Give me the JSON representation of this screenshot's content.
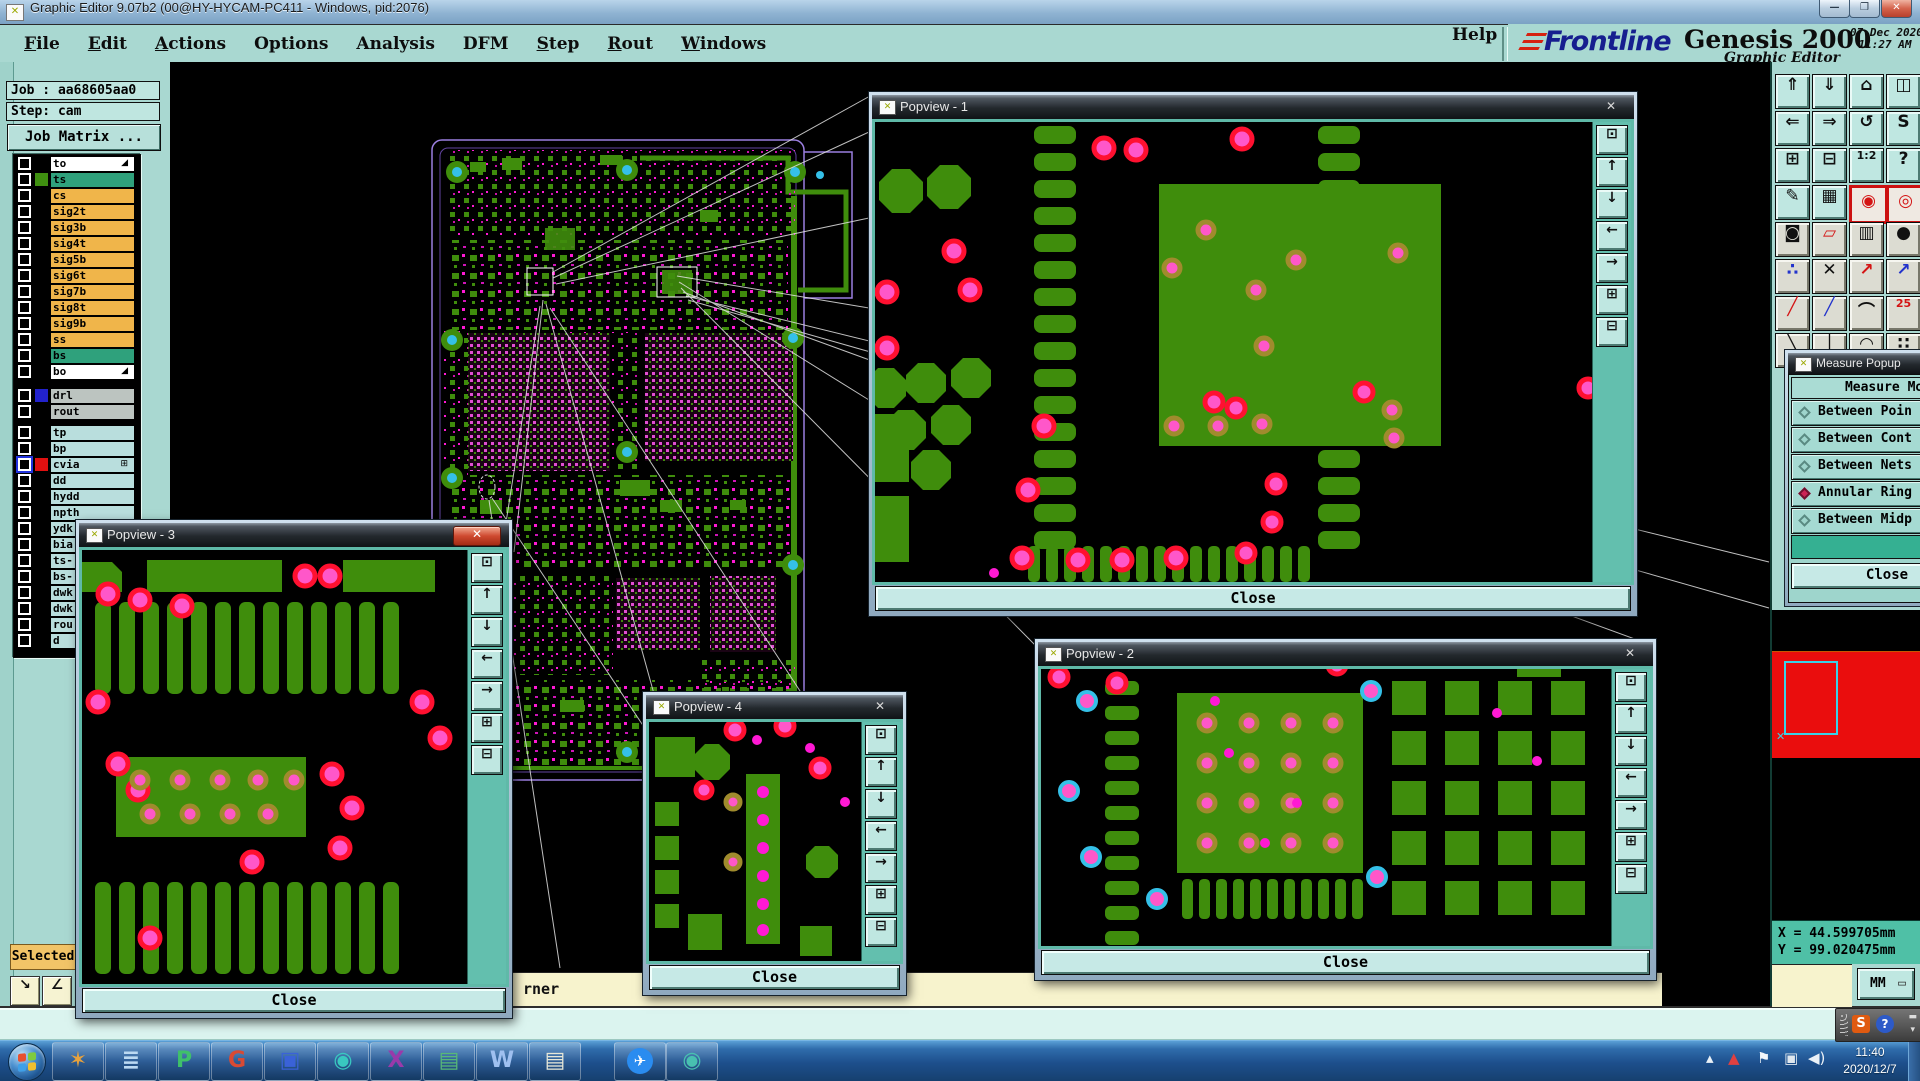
{
  "window": {
    "title": "Graphic Editor 9.07b2 (00@HY-HYCAM-PC411 - Windows, pid:2076)"
  },
  "menubar": {
    "items": [
      {
        "label": "File",
        "u": true
      },
      {
        "label": "Edit",
        "u": true
      },
      {
        "label": "Actions",
        "u": true
      },
      {
        "label": "Options",
        "u": false
      },
      {
        "label": "Analysis",
        "u": false
      },
      {
        "label": "DFM",
        "u": false
      },
      {
        "label": "Step",
        "u": true
      },
      {
        "label": "Rout",
        "u": true
      },
      {
        "label": "Windows",
        "u": true
      }
    ],
    "help": "Help"
  },
  "brand": {
    "logo": "Frontline",
    "product": "Genesis 2000",
    "subtitle": "Graphic Editor",
    "date": "07 Dec 2020",
    "time": "11:27 AM"
  },
  "job_panel": {
    "job": "Job : aa68605aa0",
    "step": "Step: cam",
    "matrix_button": "Job Matrix ..."
  },
  "layers": {
    "group1": [
      {
        "name": "to",
        "style": "white",
        "glyph": "◢"
      },
      {
        "name": "ts",
        "style": "active",
        "swatch": "#3f9010"
      },
      {
        "name": "cs",
        "style": "orange"
      },
      {
        "name": "sig2t",
        "style": "orange"
      },
      {
        "name": "sig3b",
        "style": "orange"
      },
      {
        "name": "sig4t",
        "style": "orange"
      },
      {
        "name": "sig5b",
        "style": "orange"
      },
      {
        "name": "sig6t",
        "style": "orange"
      },
      {
        "name": "sig7b",
        "style": "orange"
      },
      {
        "name": "sig8t",
        "style": "orange"
      },
      {
        "name": "sig9b",
        "style": "orange"
      },
      {
        "name": "ss",
        "style": "orange"
      },
      {
        "name": "bs",
        "style": "active"
      },
      {
        "name": "bo",
        "style": "white",
        "glyph": "◢"
      }
    ],
    "group2": [
      {
        "name": "drl",
        "style": "gray",
        "swatch": "#2222cc"
      },
      {
        "name": "rout",
        "style": "gray"
      }
    ],
    "group3": [
      {
        "name": "tp",
        "style": "cyan"
      },
      {
        "name": "bp",
        "style": "cyan"
      },
      {
        "name": "cvia",
        "style": "cyan",
        "swatch": "#e01010",
        "glyph": "⊞",
        "cbblue": true
      },
      {
        "name": "dd",
        "style": "cyan"
      },
      {
        "name": "hydd",
        "style": "cyan"
      },
      {
        "name": "npth",
        "style": "cyan"
      },
      {
        "name": "ydk",
        "style": "cyan"
      },
      {
        "name": "bia",
        "style": "cyan"
      },
      {
        "name": "ts-",
        "style": "cyan"
      },
      {
        "name": "bs-",
        "style": "cyan"
      },
      {
        "name": "dwk",
        "style": "cyan"
      },
      {
        "name": "dwk",
        "style": "cyan"
      },
      {
        "name": "rou",
        "style": "cyan"
      },
      {
        "name": "d",
        "style": "cyan"
      }
    ]
  },
  "selected_label": "Selected",
  "popviews": [
    {
      "title": "Popview - 1",
      "close_label": "Close"
    },
    {
      "title": "Popview - 2",
      "close_label": "Close"
    },
    {
      "title": "Popview - 3",
      "close_label": "Close"
    },
    {
      "title": "Popview - 4",
      "close_label": "Close"
    }
  ],
  "popview_toolbar": [
    {
      "name": "duplicate-view-button",
      "glyph": "⊡"
    },
    {
      "name": "pan-up-button",
      "glyph": "↑"
    },
    {
      "name": "pan-down-button",
      "glyph": "↓"
    },
    {
      "name": "pan-left-button",
      "glyph": "←"
    },
    {
      "name": "pan-right-button",
      "glyph": "→"
    },
    {
      "name": "zoom-fit-button",
      "glyph": "⊞"
    },
    {
      "name": "zoom-all-button",
      "glyph": "⊟"
    }
  ],
  "right_toolbar": {
    "buttons": [
      {
        "name": "paste-view-button",
        "glyph": "⇑",
        "variant": ""
      },
      {
        "name": "drop-view-button",
        "glyph": "⇓",
        "variant": ""
      },
      {
        "name": "home-view-button",
        "glyph": "⌂",
        "variant": ""
      },
      {
        "name": "split-window-button",
        "glyph": "◫",
        "variant": ""
      },
      {
        "name": "pan-left-button",
        "glyph": "⇐",
        "variant": ""
      },
      {
        "name": "pan-right-button",
        "glyph": "⇒",
        "variant": ""
      },
      {
        "name": "undo-zoom-button",
        "glyph": "↺",
        "variant": ""
      },
      {
        "name": "serpentine-button",
        "glyph": "S",
        "variant": ""
      },
      {
        "name": "zoom-out-button",
        "glyph": "⊞",
        "variant": ""
      },
      {
        "name": "zoom-in-button",
        "glyph": "⊟",
        "variant": ""
      },
      {
        "name": "zoom-scale-button",
        "glyph": "1:2",
        "variant": "small"
      },
      {
        "name": "query-button",
        "glyph": "?",
        "variant": ""
      },
      {
        "name": "tools-button",
        "glyph": "✎",
        "variant": ""
      },
      {
        "name": "grid-button",
        "glyph": "▦",
        "variant": ""
      },
      {
        "name": "net-highlight-button",
        "glyph": "◉",
        "variant": "redframe red"
      },
      {
        "name": "net-compare-button",
        "glyph": "◎",
        "variant": "redframe red"
      },
      {
        "name": "flash-mode-button",
        "glyph": "◙",
        "variant": "gray"
      },
      {
        "name": "polygon-mode-button",
        "glyph": "▱",
        "variant": "gray red"
      },
      {
        "name": "measure-ruler-button",
        "glyph": "▥",
        "variant": "gray"
      },
      {
        "name": "pad-select-button",
        "glyph": "●",
        "variant": "gray"
      },
      {
        "name": "net-points-button",
        "glyph": "∴",
        "variant": "gray blue"
      },
      {
        "name": "delete-button",
        "glyph": "✕",
        "variant": "gray"
      },
      {
        "name": "vector-red-button",
        "glyph": "↗",
        "variant": "gray red"
      },
      {
        "name": "vector-blue-button",
        "glyph": "↗",
        "variant": "gray blue"
      },
      {
        "name": "line-red-button",
        "glyph": "╱",
        "variant": "gray red"
      },
      {
        "name": "line-dual-button",
        "glyph": "╱",
        "variant": "gray blue"
      },
      {
        "name": "arc-button",
        "glyph": "⌒",
        "variant": "gray"
      },
      {
        "name": "pair-digits-button",
        "glyph": "25",
        "variant": "gray red small"
      },
      {
        "name": "line-back-button",
        "glyph": "╲",
        "variant": "gray"
      },
      {
        "name": "vline-button",
        "glyph": "│",
        "variant": "gray"
      },
      {
        "name": "arc2-button",
        "glyph": "◠",
        "variant": "gray"
      },
      {
        "name": "dots-button",
        "glyph": "∷",
        "variant": "gray"
      }
    ]
  },
  "measure_popup": {
    "title": "Measure Popup",
    "header": "Measure Mod",
    "options": [
      {
        "label": "Between Poin",
        "selected": false
      },
      {
        "label": "Between Cont",
        "selected": false
      },
      {
        "label": "Between Nets",
        "selected": false
      },
      {
        "label": "Annular Ring",
        "selected": true
      },
      {
        "label": "Between Midp",
        "selected": false
      }
    ],
    "close_label": "Close"
  },
  "readout": {
    "x": "X = 44.599705mm",
    "y": "Y = 99.020475mm",
    "units": "MM"
  },
  "prompt": {
    "visible_text": "rner"
  },
  "taskbar": {
    "buttons": [
      {
        "name": "taskbar-shell-icon",
        "glyph": "✶",
        "fg": "#e8a23c"
      },
      {
        "name": "taskbar-notes-icon",
        "glyph": "≣",
        "fg": "#bcd9f2"
      },
      {
        "name": "taskbar-genesis-p-icon",
        "glyph": "P",
        "fg": "#3fc06a"
      },
      {
        "name": "taskbar-genesis-g-icon",
        "glyph": "G",
        "fg": "#d84a34"
      },
      {
        "name": "taskbar-save-icon",
        "glyph": "▣",
        "fg": "#3a62d8"
      },
      {
        "name": "taskbar-disc-burn-icon",
        "glyph": "◉",
        "fg": "#39c8c0"
      },
      {
        "name": "taskbar-exceed-icon",
        "glyph": "X",
        "fg": "#9a3aaa"
      },
      {
        "name": "taskbar-excel-icon",
        "glyph": "▤",
        "fg": "#58b878"
      },
      {
        "name": "taskbar-word-icon",
        "glyph": "W",
        "fg": "#9fc0f0"
      },
      {
        "name": "taskbar-notepad-icon",
        "glyph": "▤",
        "fg": "#e8e8d8"
      },
      {
        "name": "taskbar-dingtalk-icon",
        "glyph": "✈",
        "fg": "#ffffff",
        "circle": "#2a8cf0"
      },
      {
        "name": "taskbar-disc2-icon",
        "glyph": "◉",
        "fg": "#48c0b0"
      }
    ],
    "tray": [
      {
        "name": "tray-hidden-icons-button",
        "glyph": "▴",
        "fg": "#eaf1f7"
      },
      {
        "name": "tray-antivirus-icon",
        "glyph": "▲",
        "fg": "#e04040"
      },
      {
        "name": "tray-action-center-icon",
        "glyph": "⚑",
        "fg": "#f2f6fa"
      },
      {
        "name": "tray-network-icon",
        "glyph": "▣",
        "fg": "#dfe7ee"
      },
      {
        "name": "tray-volume-icon",
        "glyph": "◀)",
        "fg": "#eaf1f7"
      }
    ],
    "time": "11:40",
    "date": "2020/12/7"
  },
  "language_bar": {
    "ime": "S",
    "help": "?"
  }
}
